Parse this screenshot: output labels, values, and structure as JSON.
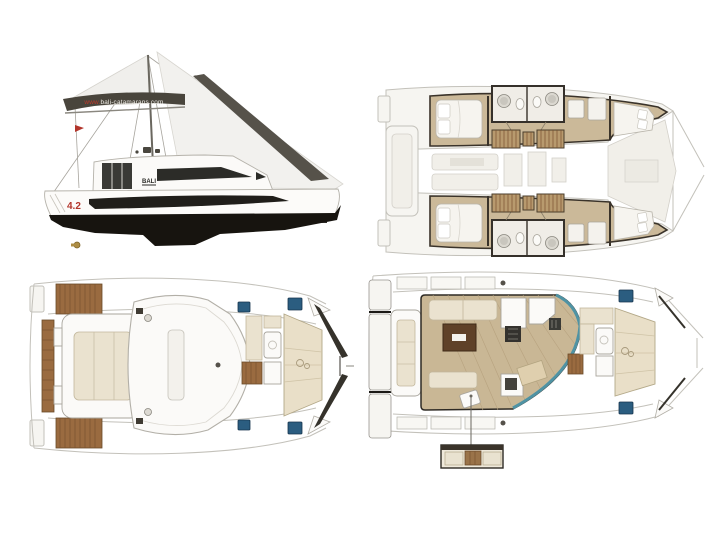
{
  "page": {
    "background": "#ffffff"
  },
  "side_view": {
    "sail_url_prefix": "www.",
    "sail_url_domain": "bali-catamarans.com",
    "cabin_brand": "BALI",
    "model": "4.2",
    "stern_brand": "BALI"
  },
  "palette": {
    "accent_red": "#b2352b",
    "sail_logo_band": "#49453c",
    "hull_underwater": "#17140f",
    "teak_wood": "#9a6b40",
    "floor_tan": "#c9b795",
    "cushion_beige": "#eae2cf",
    "hatch_blue": "#2b5d80",
    "front_glass_teal": "#4f93a4",
    "ghost_outline_gray": "#c3c1ba",
    "wall_dark": "#3a332a"
  }
}
